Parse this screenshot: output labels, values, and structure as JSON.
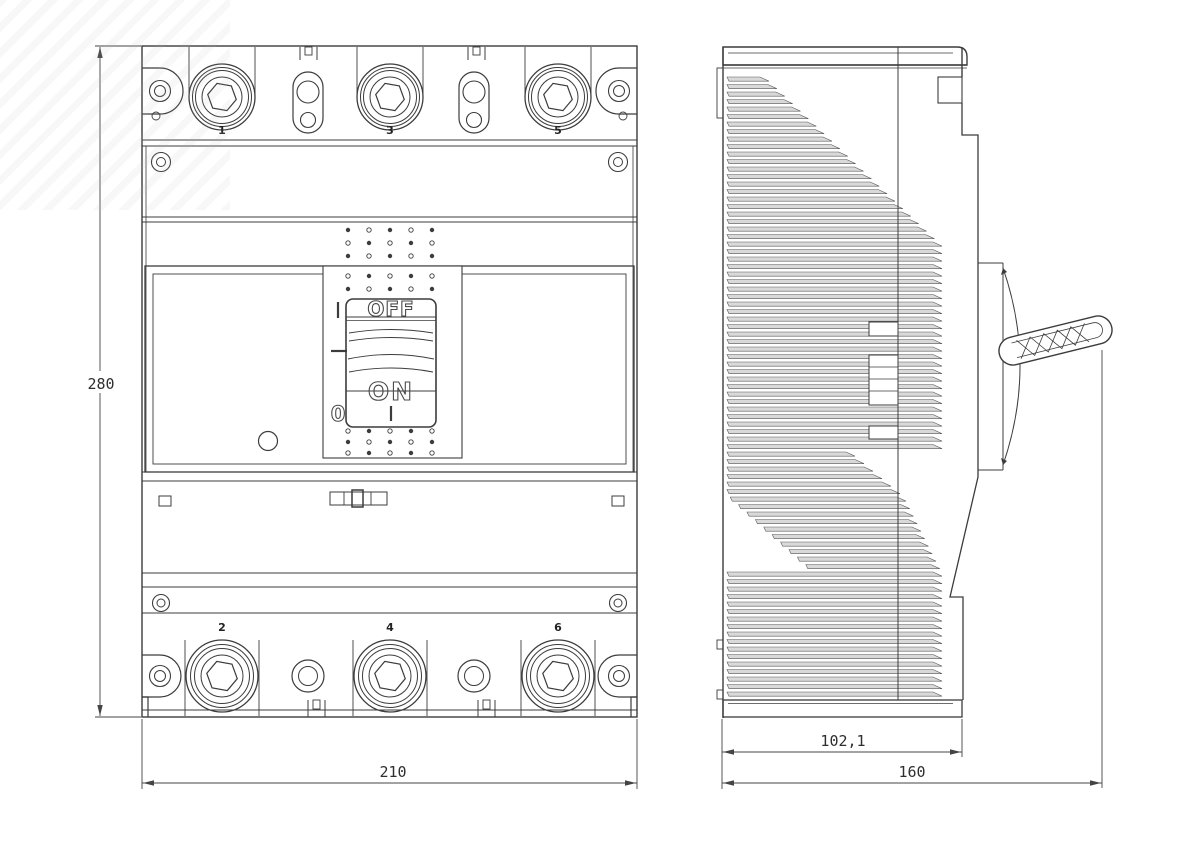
{
  "drawing_title": "molded-case-circuit-breaker-dimensional-drawing",
  "front_view": {
    "top_terminals": [
      "1",
      "3",
      "5"
    ],
    "bottom_terminals": [
      "2",
      "4",
      "6"
    ],
    "toggle": {
      "off_label": "OFF",
      "on_label": "ON",
      "position_on_symbol": "I",
      "position_off_symbol": "0"
    },
    "dim_height": "280",
    "dim_width": "210"
  },
  "side_view": {
    "dim_depth_body": "102,1",
    "dim_depth_total": "160"
  },
  "colors": {
    "line": "#3c3c3c",
    "fin_fill": "#d9d9d9",
    "dim": "#2e2e2e",
    "background": "#ffffff"
  }
}
